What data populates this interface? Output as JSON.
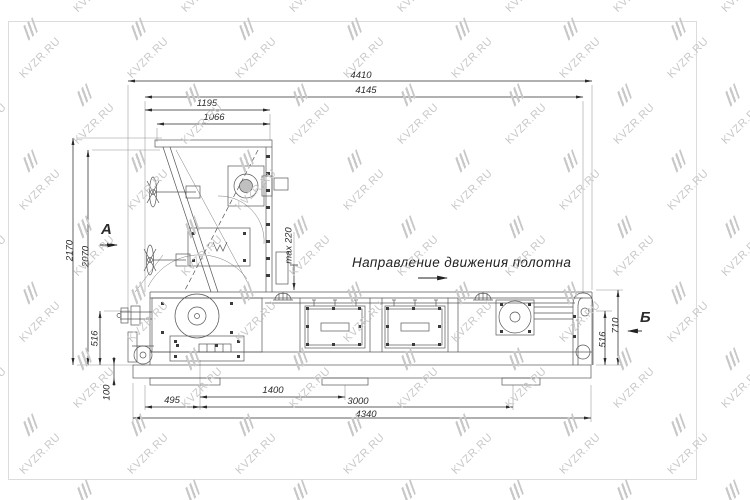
{
  "watermark": {
    "text": "KVZR.RU",
    "color": "#c8c8c8"
  },
  "labels": {
    "direction": "Направление движения полотна",
    "view_a": "А",
    "view_b": "Б"
  },
  "dims": {
    "overall_top": "4410",
    "top_2": "4145",
    "hopper_1": "1195",
    "hopper_2": "1066",
    "height_1": "2170",
    "height_2": "2070",
    "max_gap": "max 220",
    "left_516": "516",
    "base_height": "100",
    "bottom_495": "495",
    "bottom_1400": "1400",
    "bottom_3000": "3000",
    "bottom_4340": "4340",
    "right_516": "516",
    "right_710": "710"
  },
  "colors": {
    "line": "#565656",
    "dim": "#2b2b2b",
    "frame": "#dcdcdc",
    "watermark": "#c8c8c8"
  }
}
